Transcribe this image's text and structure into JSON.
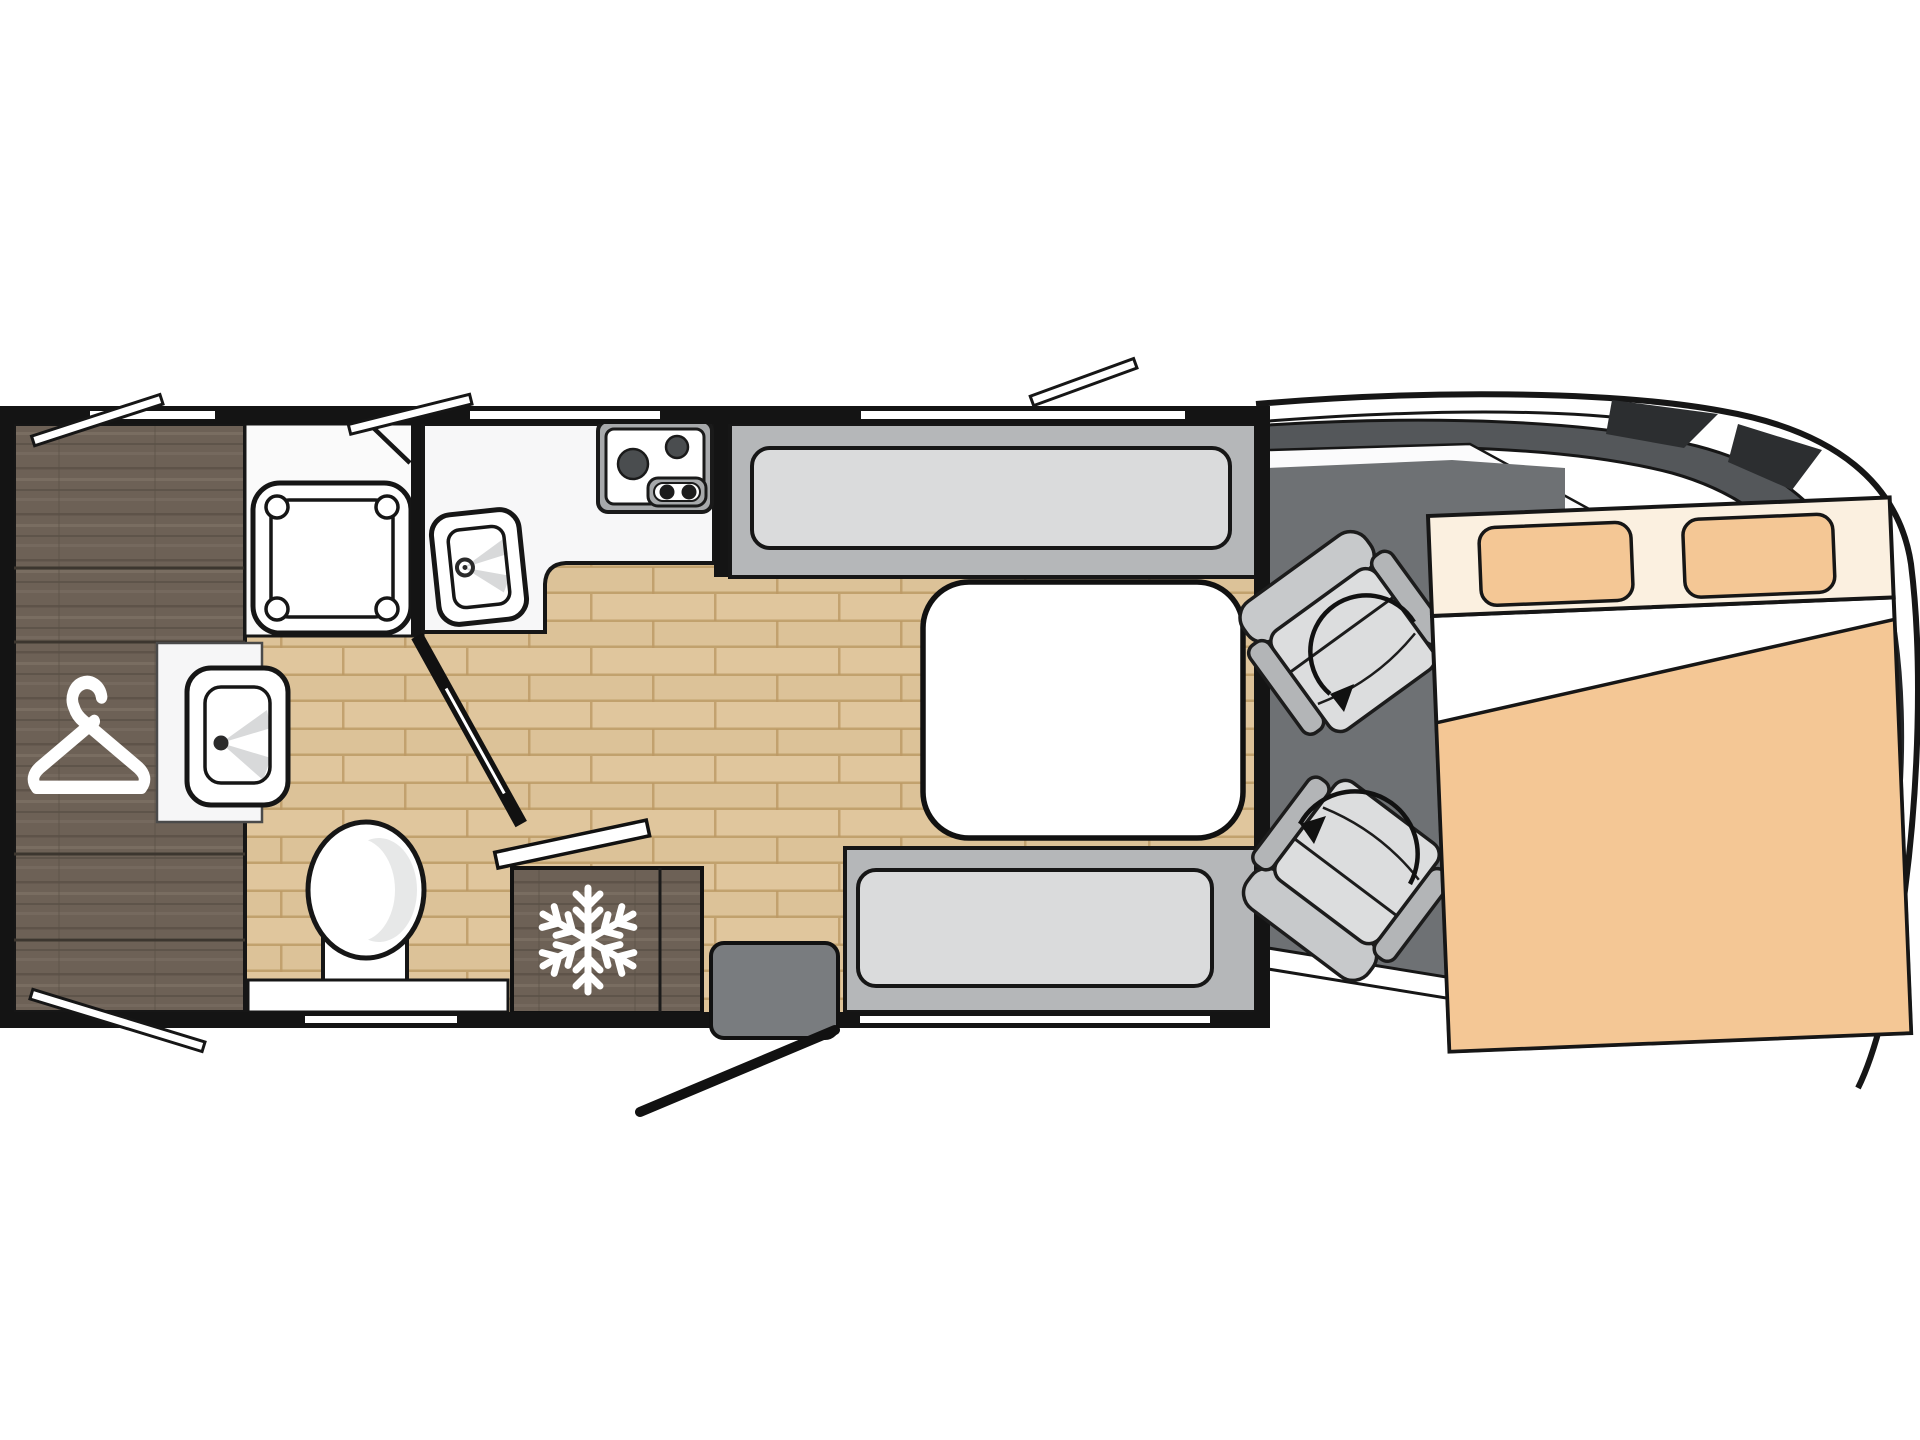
{
  "diagram": {
    "title": "Motorhome floor plan (top view)",
    "type": "floorplan",
    "vehicle": {
      "kind": "coachbuilt-motorhome",
      "cab_seat_count": 2,
      "cab_seat_feature": "swivel-seats-with-rotation-arrows"
    },
    "rooms": [
      {
        "id": "wardrobe",
        "furniture": [
          "wardrobe-shelving"
        ],
        "icon": "hanger-icon"
      },
      {
        "id": "washroom",
        "furniture": [
          "shower-tray",
          "washbasin",
          "toilet"
        ]
      },
      {
        "id": "kitchen",
        "furniture": [
          "two-burner-hob",
          "kitchen-sink",
          "refrigerator"
        ],
        "icon": "snowflake-icon"
      },
      {
        "id": "dinette",
        "furniture": [
          "bench-seat-front",
          "bench-seat-rear",
          "table"
        ]
      },
      {
        "id": "cab",
        "furniture": [
          "swivel-seat-1",
          "swivel-seat-2"
        ],
        "icon": "rotation-arrow-icon"
      },
      {
        "id": "bedroom",
        "furniture": [
          "double-bed",
          "pillow-left",
          "pillow-right",
          "duvet"
        ]
      }
    ],
    "openings": {
      "entry_door_count": 1,
      "entry_step_count": 1,
      "top_wall_windows": 3,
      "bottom_wall_windows": 2,
      "interior_doors": 2
    },
    "colors": {
      "wall": "#141414",
      "outline": "#161616",
      "wood_floor": "#dcc298",
      "dark_wood": "#6d6156",
      "counter": "#f7f7f8",
      "table": "#ffffff",
      "bench": "#b5b7b9",
      "cushion": "#dadbdc",
      "cab_floor": "#6e7174",
      "windshield": "#54575a",
      "body_fin": "#2c2e30",
      "seat": "#c7c9cb",
      "seat_light": "#dcddde",
      "seat_dark": "#b3b5b7",
      "bed_peach": "#f4c795",
      "bed_cream": "#fbf0e0",
      "step": "#797c7f",
      "icon_white": "#ffffff"
    }
  }
}
